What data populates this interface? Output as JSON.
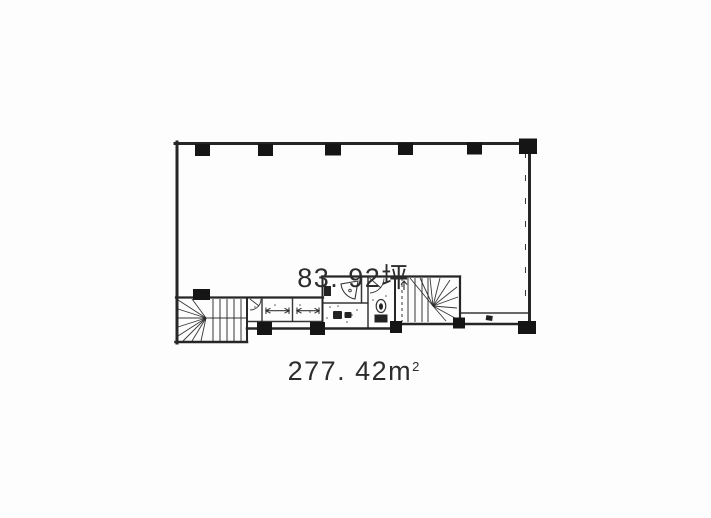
{
  "page": {
    "background": "#fdfdfd"
  },
  "plan": {
    "labels": {
      "area_tsubo": "83. 92坪",
      "area_sqm_value": "277. 42",
      "area_sqm_unit": "m",
      "area_sqm_exponent": "2"
    },
    "colors": {
      "wall_line": "#262626",
      "column_fill": "#151515",
      "label_text": "#2c2c2c",
      "paper": "#fdfdfd"
    },
    "icons": {
      "left_staircase": "winder-staircase",
      "right_staircase": "winder-staircase",
      "elevator_door_symbol": "double-headed-arrow",
      "toilet": "toilet-fixture",
      "basin": "wall-mounted-sink",
      "column": "structural-column-square"
    },
    "counts": {
      "top_wall_columns": 6,
      "service_band_columns": 6,
      "elevators": 2
    }
  }
}
